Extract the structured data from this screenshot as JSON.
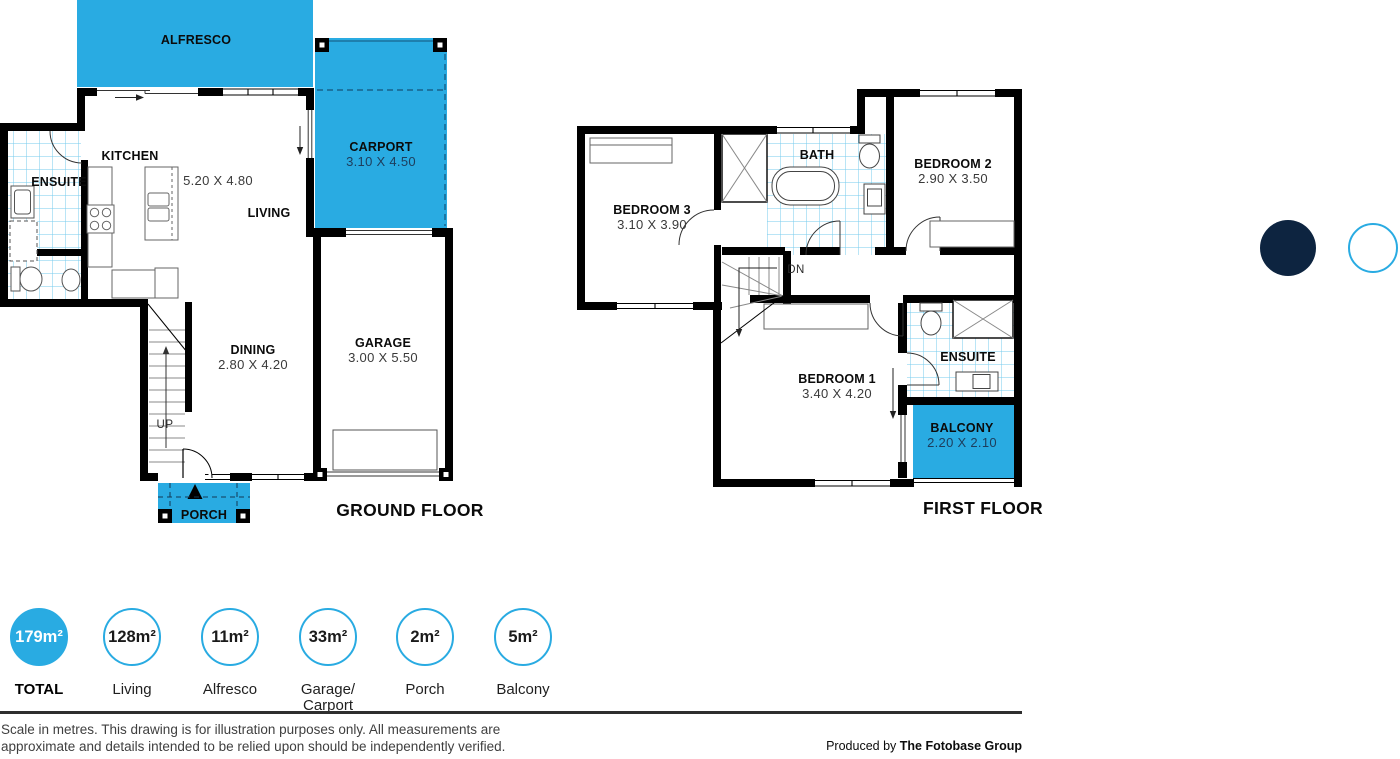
{
  "colors": {
    "accent_cyan": "#29ABE2",
    "navy": "#0D2440",
    "wall_black": "#000000",
    "tile_line": "#76CBEE"
  },
  "ground_floor": {
    "title": "GROUND FLOOR",
    "rooms": {
      "alfresco": {
        "name": "ALFRESCO",
        "dims": ""
      },
      "carport": {
        "name": "CARPORT",
        "dims": "3.10 X 4.50"
      },
      "kitchen": {
        "name": "KITCHEN",
        "dims": ""
      },
      "ensuite": {
        "name": "ENSUITE",
        "dims": ""
      },
      "living": {
        "name": "LIVING",
        "dims": "5.20 X 4.80"
      },
      "dining": {
        "name": "DINING",
        "dims": "2.80 X 4.20"
      },
      "garage": {
        "name": "GARAGE",
        "dims": "3.00 X 5.50"
      },
      "porch": {
        "name": "PORCH",
        "dims": ""
      },
      "stairs": {
        "label": "UP"
      }
    }
  },
  "first_floor": {
    "title": "FIRST FLOOR",
    "rooms": {
      "bedroom3": {
        "name": "BEDROOM 3",
        "dims": "3.10 X 3.90"
      },
      "bath": {
        "name": "BATH",
        "dims": ""
      },
      "bedroom2": {
        "name": "BEDROOM 2",
        "dims": "2.90 X 3.50"
      },
      "bedroom1": {
        "name": "BEDROOM 1",
        "dims": "3.40 X 4.20"
      },
      "ensuite": {
        "name": "ENSUITE",
        "dims": ""
      },
      "balcony": {
        "name": "BALCONY",
        "dims": "2.20 X 2.10"
      },
      "stairs": {
        "label": "DN"
      }
    }
  },
  "legend": {
    "items": [
      {
        "value": "179m²",
        "label": "TOTAL",
        "filled": true
      },
      {
        "value": "128m²",
        "label": "Living",
        "filled": false
      },
      {
        "value": "11m²",
        "label": "Alfresco",
        "filled": false
      },
      {
        "value": "33m²",
        "label": "Garage/\nCarport",
        "filled": false
      },
      {
        "value": "2m²",
        "label": "Porch",
        "filled": false
      },
      {
        "value": "5m²",
        "label": "Balcony",
        "filled": false
      }
    ]
  },
  "footer": {
    "disclaimer": "Scale in metres. This drawing is for illustration purposes only. All measurements are\napproximate and details intended to be relied upon should be independently verified.",
    "produced_by_prefix": "Produced by ",
    "producer": "The Fotobase Group"
  }
}
